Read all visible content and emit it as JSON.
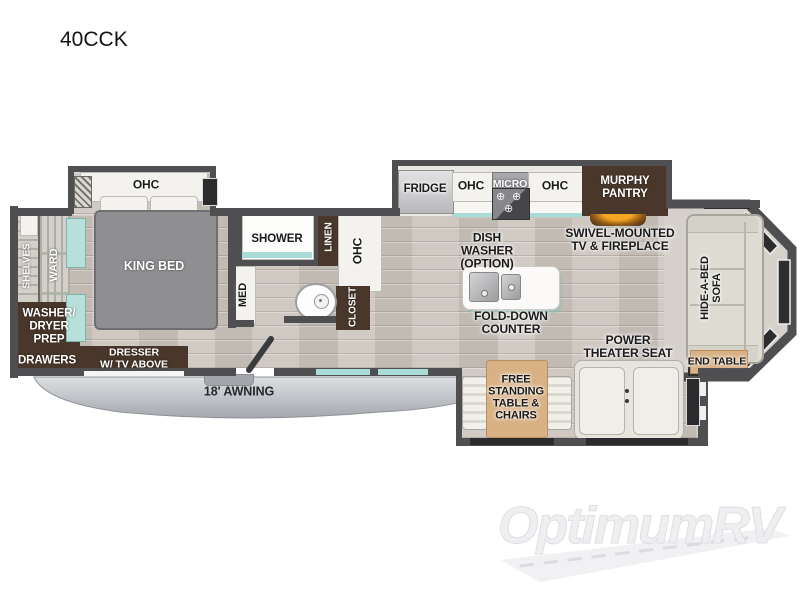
{
  "title": "40CCK",
  "watermark": {
    "logo_text": "OptimumRV"
  },
  "colors": {
    "wall": "#4f4f52",
    "cabinet_brown": "#4a372b",
    "accent_teal": "#a9dcd6",
    "tan": "#d8b184",
    "bed_gray": "#8f8f92",
    "fireplace_glow": "#f5a623",
    "floor_wood": "#ccc5be",
    "awning_gray": "#b6bac0"
  },
  "rooms": {
    "bedroom": {
      "ohc": "OHC",
      "king_bed": "KING BED",
      "dresser": "DRESSER\nW/ TV ABOVE"
    },
    "front_wardrobe": {
      "shelves": "SHELVES",
      "ward": "WARD",
      "washer_dryer_prep": "WASHER/\nDRYER\nPREP",
      "drawers": "DRAWERS"
    },
    "bathroom": {
      "shower": "SHOWER",
      "med": "MED",
      "linen": "LINEN",
      "ohc": "OHC",
      "closet": "CLOSET"
    },
    "kitchen": {
      "fridge": "FRIDGE",
      "ohc_left": "OHC",
      "micro": "MICRO",
      "ohc_right": "OHC",
      "murphy_pantry": "MURPHY\nPANTRY",
      "dish_washer_option": "DISH\nWASHER\n(OPTION)",
      "fold_down_counter": "FOLD-DOWN\nCOUNTER"
    },
    "living_area": {
      "swivel_tv_fireplace": "SWIVEL-MOUNTED\nTV & FIREPLACE",
      "power_theater_seat": "POWER\nTHEATER SEAT",
      "free_standing_table_chairs": "FREE\nSTANDING\nTABLE &\nCHAIRS",
      "hide_a_bed_sofa": "HIDE-A-BED\nSOFA",
      "end_table": "END TABLE"
    },
    "exterior": {
      "awning": "18' AWNING"
    }
  }
}
